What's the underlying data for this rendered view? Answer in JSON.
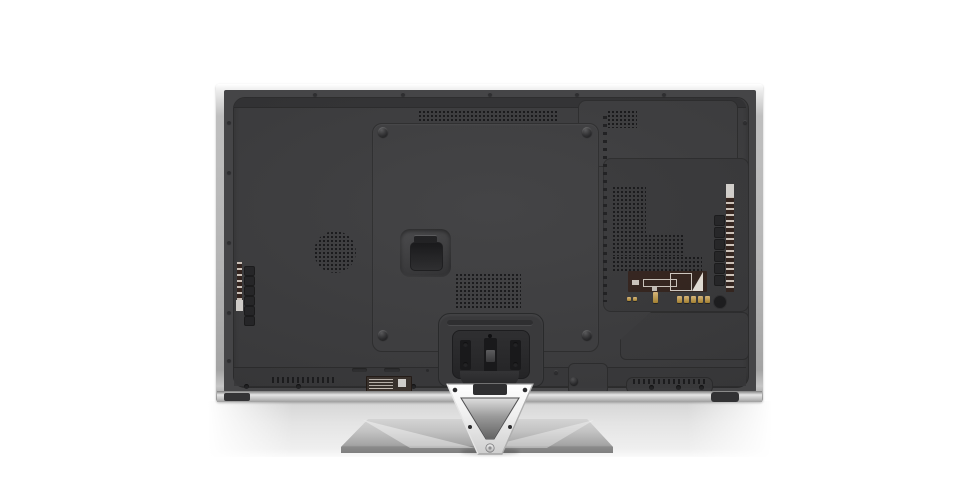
{
  "scene": {
    "subject": "Rear view of a flat-panel television on a V-shaped pedestal stand",
    "view": "back panel, studio product photo on white background"
  },
  "parts": {
    "frame": "silver bezel frame",
    "back_panel": "charcoal rear cover",
    "vesa_panel": "central mounting panel with four corner screws",
    "handle": "recessed carry handle",
    "speaker": "circular speaker perforation",
    "top_vent": "horizontal cooling vent strip",
    "right_vents": "stepped cooling vent block",
    "side_ports": "connector column with label strip",
    "control_buttons": "side control button column",
    "regulatory_labels": "brown regulatory/connection labels with fine print",
    "antenna_connectors": "gold antenna terminals",
    "stand_mount": "stand attachment plate with three slots",
    "stand_bracket": "chrome V-shaped stand neck",
    "stand_base": "flat silver pedestal base"
  },
  "colors": {
    "background": "#ffffff",
    "frame_silver": "#bfbfbf",
    "frame_highlight": "#ffffff",
    "panel_dark": "#3c3c3e",
    "panel_rim": "#454547",
    "panel_raised": "#3e3e40",
    "panel_section": "#38383a",
    "groove": "#323234",
    "seam": "#2c2c2d",
    "vent_dot": "#131315",
    "recess": "#242426",
    "slot": "#19191b",
    "label_brown": "#33231d",
    "label_white": "#d9d6d2",
    "gold": "#e0bc7d",
    "gold_dark": "#a9842f",
    "chrome_light": "#ffffff",
    "chrome_mid": "#e3e3e3",
    "chrome_edge": "#9b9b9b",
    "base_light": "#d4d4d4",
    "base_dark": "#a3a3a3",
    "base_rim": "#8a8a8a",
    "shadow_band": "#dcdcdc",
    "foot": "#343436"
  }
}
